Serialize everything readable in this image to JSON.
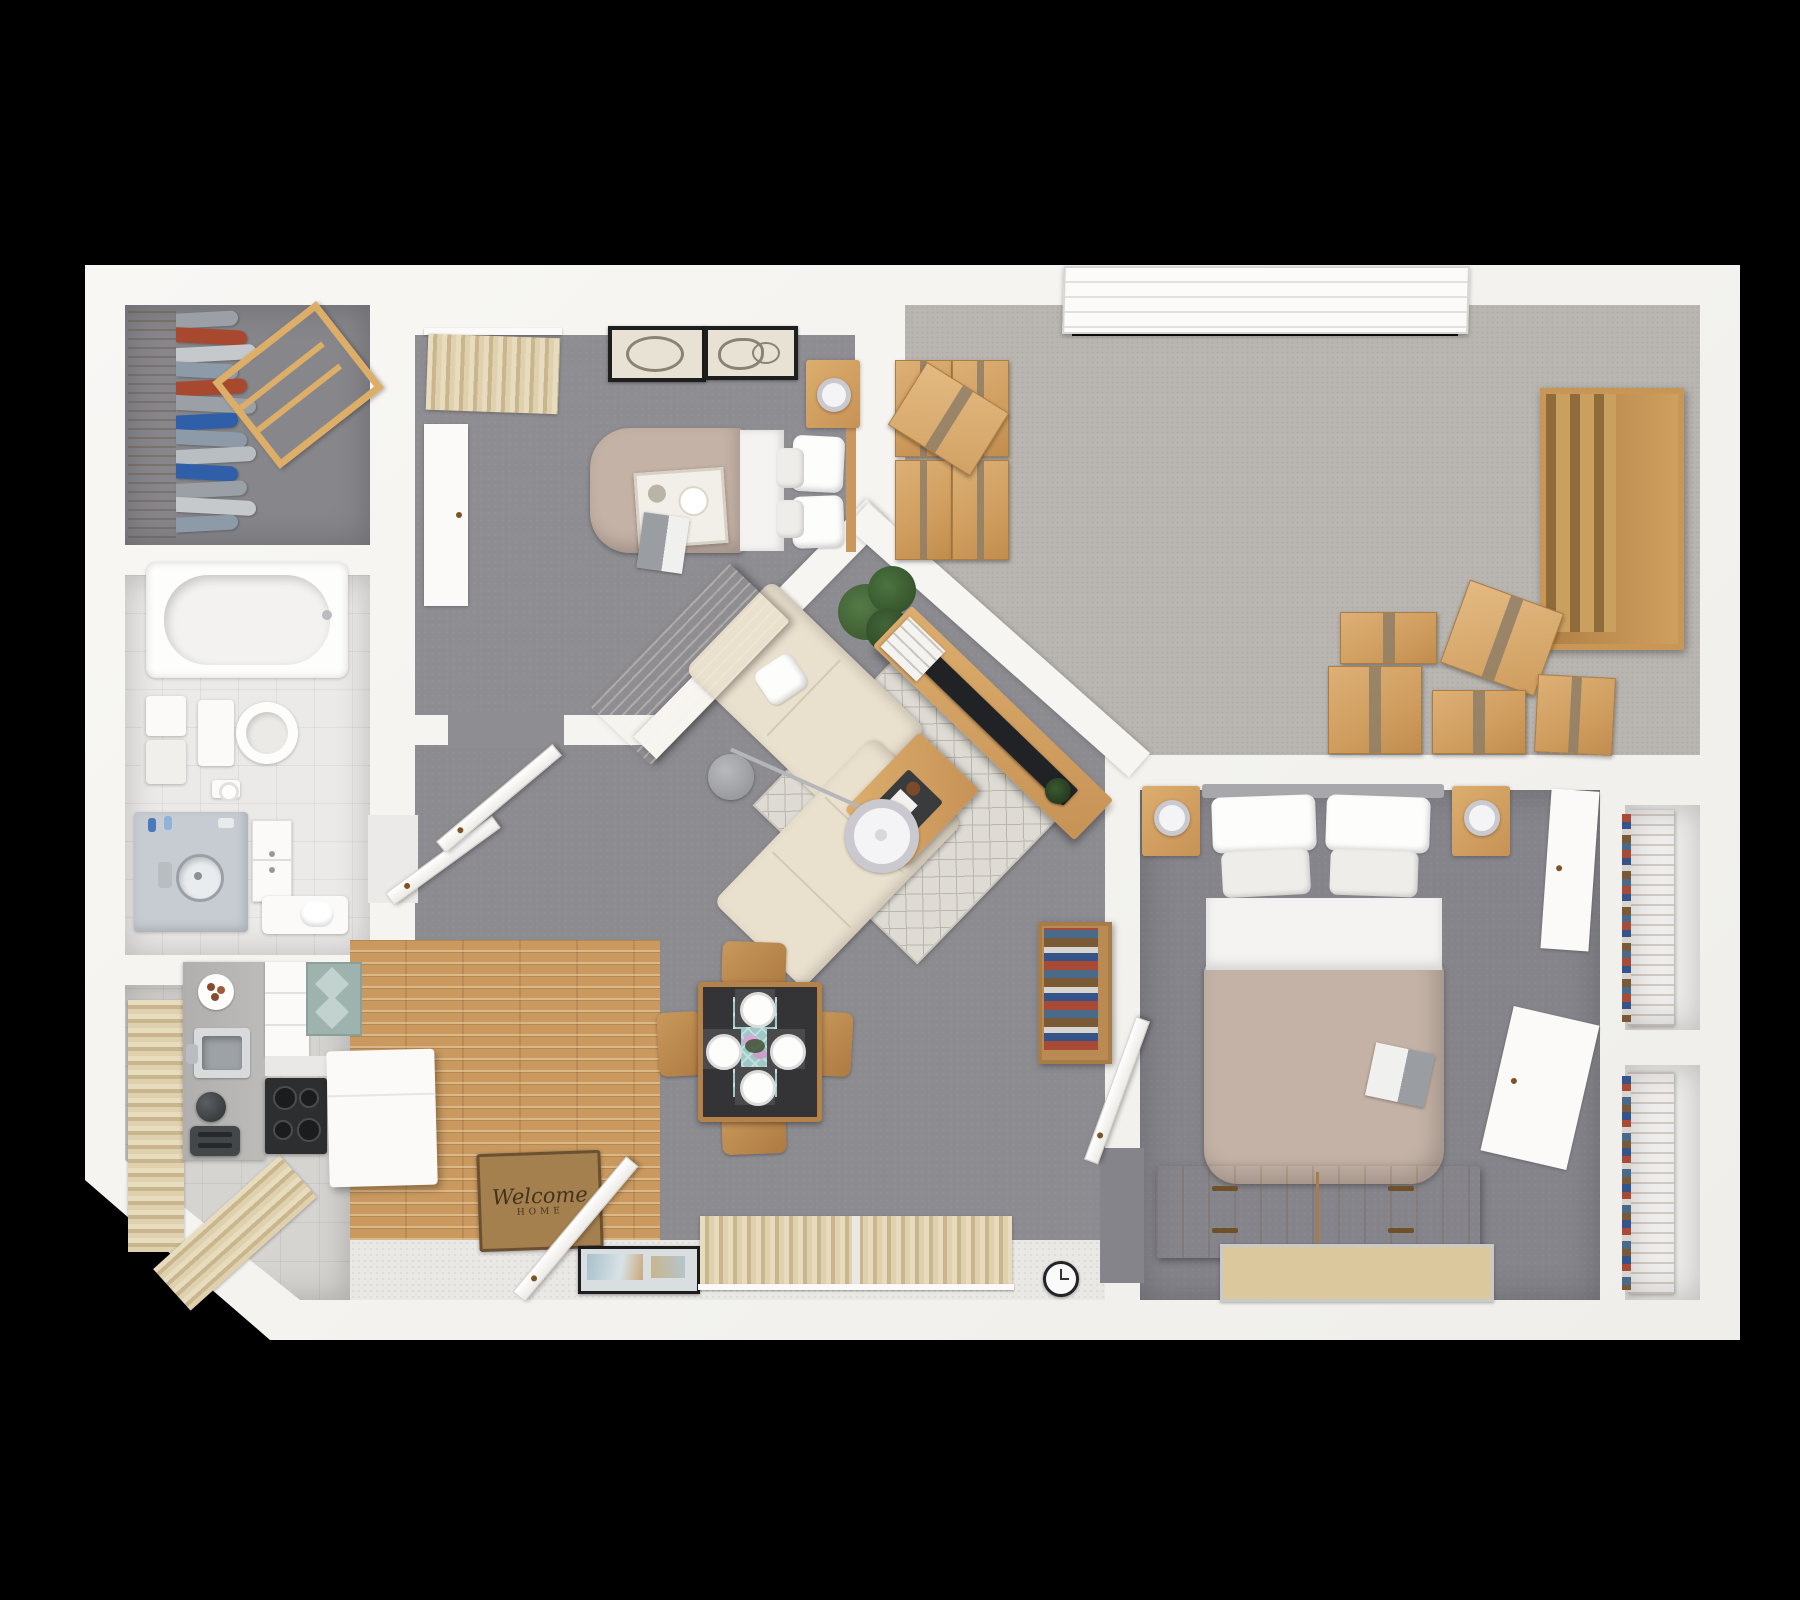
{
  "scene": {
    "description": "3D rendered top-down floor plan of a two-bedroom apartment with living room, kitchen, bathroom, laundry closet, storage room and hall closets",
    "background_color": "#000000"
  },
  "palette": {
    "wall": "#f6f5f2",
    "outer_shadow": "#9b9b9b",
    "living_floor": "#8c8b90",
    "bedroom_small_floor": "#8e8d92",
    "bedroom_master_floor": "#84848a",
    "closet_room_floor": "#87868b",
    "storage_carpet": "#b9b6b1",
    "bathroom_tile": "#eceae8",
    "kitchen_tile": "#d6d4d1",
    "entry_tile": "#eae8e5",
    "wood_floor": "#c9995f",
    "wood_furniture": "#cf9e60",
    "sofa_cream": "#eae0ce",
    "bed_taupe": "#c4b2a6",
    "curtain_beige": "#d9c8a9",
    "cardboard": "#d2a264",
    "plant_green": "#44663a",
    "tv_black": "#212225"
  },
  "doormat": {
    "line1": "Welcome",
    "line2": "HOME"
  },
  "closet": {
    "clothes_colors": [
      "#9aa0a6",
      "#a8492f",
      "#c6c9cc",
      "#8d9aa8",
      "#a8492f",
      "#9aa0a6",
      "#2e5fa8",
      "#8d9aa8",
      "#b9bec2",
      "#2e5fa8",
      "#9aa0a6",
      "#c6c9cc",
      "#8d9aa8"
    ]
  },
  "rooms": [
    {
      "id": "laundry-closet",
      "furniture": [
        "clothes-rack",
        "hanging-clothes",
        "drying-rack"
      ]
    },
    {
      "id": "bathroom",
      "furniture": [
        "bathtub",
        "towel-rack",
        "toilet",
        "toilet-paper-holder",
        "vanity-sink",
        "bathroom-cabinet",
        "bench"
      ]
    },
    {
      "id": "kitchen",
      "furniture": [
        "window-curtains",
        "counter",
        "kitchen-sink",
        "stove",
        "cabinets",
        "island",
        "toaster",
        "kettle",
        "kitchen-rug",
        "food-plate"
      ]
    },
    {
      "id": "entry",
      "furniture": [
        "front-door",
        "doormat",
        "picture-frame",
        "wall-clock",
        "window-curtains"
      ]
    },
    {
      "id": "living-dining",
      "furniture": [
        "sectional-sofa",
        "throw-pillow",
        "area-rug",
        "coffee-table",
        "arc-floor-lamp",
        "media-console",
        "tv",
        "magazines",
        "potted-plant",
        "small-plant",
        "bookcase",
        "dining-table",
        "dining-chairs",
        "place-settings",
        "table-runner",
        "flowers"
      ]
    },
    {
      "id": "bedroom-small",
      "furniture": [
        "bed",
        "pillows",
        "breakfast-tray",
        "book",
        "nightstand",
        "lamp",
        "desk",
        "wardrobe",
        "wall-art",
        "window-curtains",
        "door"
      ]
    },
    {
      "id": "storage-room",
      "furniture": [
        "garage-door",
        "moving-boxes",
        "wall-shelf"
      ]
    },
    {
      "id": "bedroom-master",
      "furniture": [
        "double-bed",
        "pillows",
        "book",
        "nightstand-left",
        "nightstand-right",
        "lamps",
        "dresser",
        "wood-mat",
        "closet-door-panels",
        "door"
      ]
    },
    {
      "id": "hall-closets",
      "furniture": [
        "shelving-with-books"
      ]
    }
  ]
}
